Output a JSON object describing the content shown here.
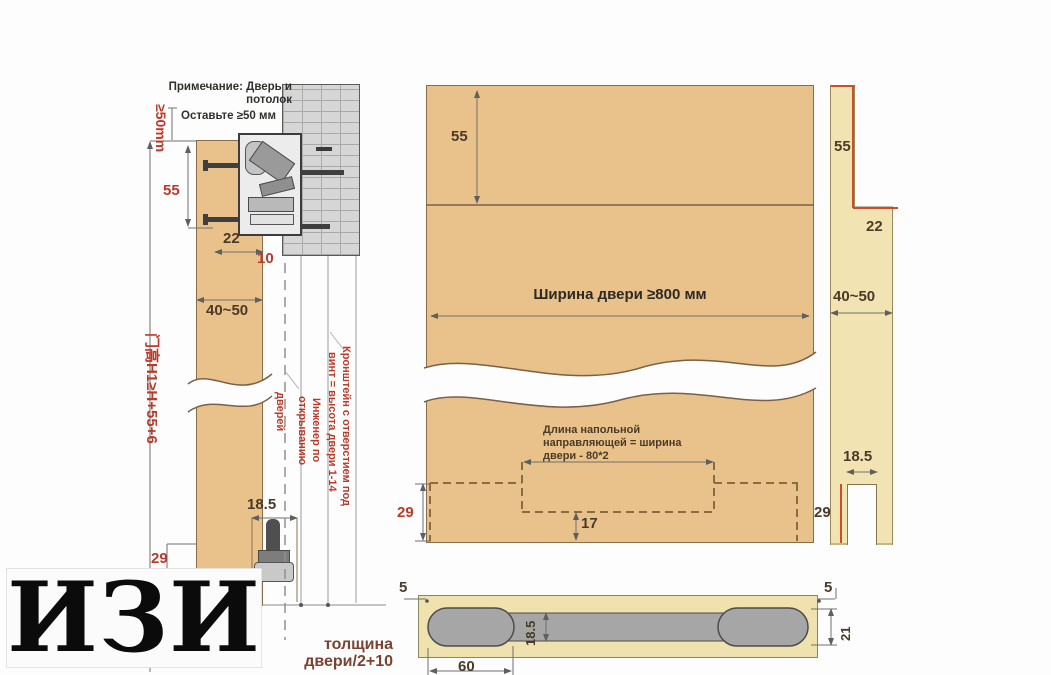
{
  "watermark": {
    "text": "ИЗИ"
  },
  "colors": {
    "panel_tan": "#e9c28b",
    "strip_yellow": "#f2e4b2",
    "annotation_red": "#bb3a2a",
    "accent_orange": "#cc4f28",
    "dim_dark": "#4a3b28",
    "hardware_gray": "#a6a6a6"
  },
  "left": {
    "note1": "Примечание: Дверь и",
    "note2": "потолок",
    "leave": "Оставьте ≥50 мм",
    "gap": "≥50mm",
    "d55": "55",
    "d22": "22",
    "d10": "10",
    "d4050": "40~50",
    "height_formula": "门高H1≥H+55+6",
    "ann1a": "Кронштейн с отверстием под",
    "ann1b": "винт = высота двери 1-14",
    "ann2a": "Инженер по",
    "ann2b": "открыванию",
    "ann2c": "дверей",
    "d185": "18.5",
    "d29": "29",
    "thick1": "толщина",
    "thick2": "двери/2+10"
  },
  "middle": {
    "d55": "55",
    "width_label": "Ширина двери ≥800 мм",
    "guide1": "Длина напольной",
    "guide2": "направляющей = ширина",
    "guide3": "двери - 80*2",
    "d17": "17",
    "d29": "29"
  },
  "right": {
    "d55": "55",
    "d22": "22",
    "d4050": "40~50",
    "d185": "18.5",
    "d29": "29"
  },
  "bottom": {
    "d5l": "5",
    "d5r": "5",
    "d185": "18.5",
    "d21": "21",
    "d60": "60"
  }
}
